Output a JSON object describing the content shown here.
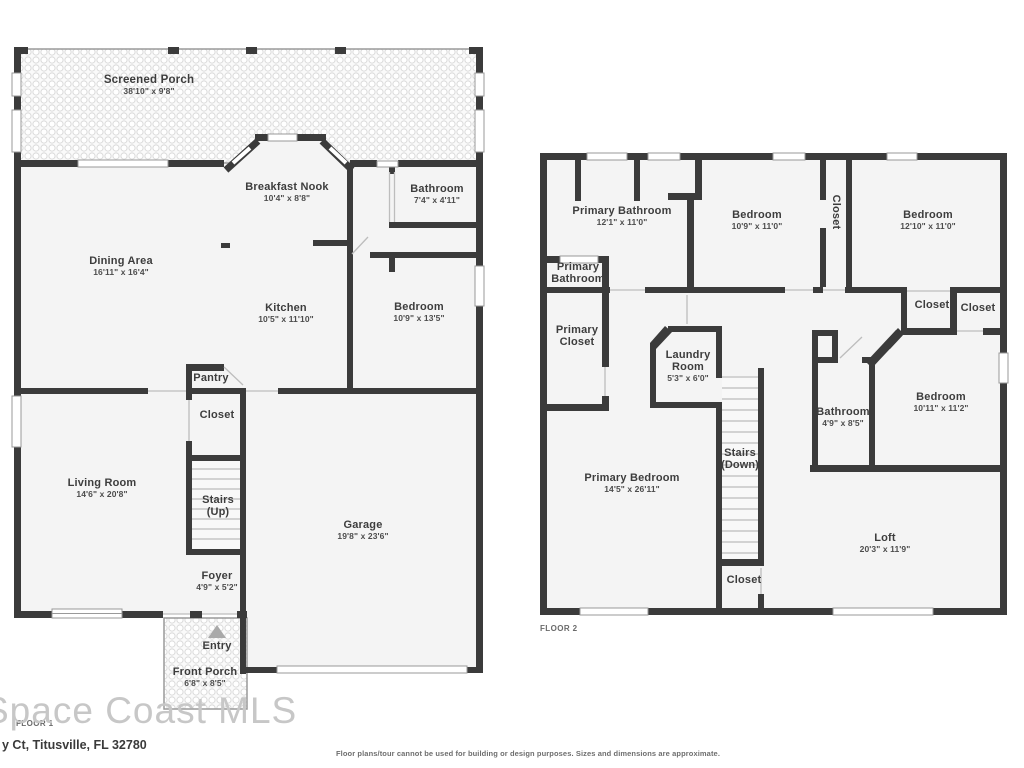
{
  "watermark": "Space Coast MLS",
  "address": "y Ct, Titusville, FL 32780",
  "disclaimer": "Floor plans/tour cannot be used for building or design purposes. Sizes and dimensions are approximate.",
  "colors": {
    "wall": "#3b3b3b",
    "room_fill": "#f4f4f4",
    "text": "#3d3d3d",
    "watermark": "#c7c7c7"
  },
  "floor1": {
    "caption": "FLOOR 1",
    "rooms": {
      "screened_porch": {
        "name": "Screened Porch",
        "dims": "38'10\" x 9'8\""
      },
      "breakfast_nook": {
        "name": "Breakfast Nook",
        "dims": "10'4\" x 8'8\""
      },
      "bathroom": {
        "name": "Bathroom",
        "dims": "7'4\" x 4'11\""
      },
      "dining_area": {
        "name": "Dining Area",
        "dims": "16'11\" x 16'4\""
      },
      "kitchen": {
        "name": "Kitchen",
        "dims": "10'5\" x 11'10\""
      },
      "bedroom": {
        "name": "Bedroom",
        "dims": "10'9\" x 13'5\""
      },
      "pantry": {
        "name": "Pantry"
      },
      "closet": {
        "name": "Closet"
      },
      "living_room": {
        "name": "Living Room",
        "dims": "14'6\" x 20'8\""
      },
      "stairs": {
        "name": "Stairs",
        "dims": "(Up)"
      },
      "garage": {
        "name": "Garage",
        "dims": "19'8\" x 23'6\""
      },
      "foyer": {
        "name": "Foyer",
        "dims": "4'9\" x 5'2\""
      },
      "entry": {
        "name": "Entry"
      },
      "front_porch": {
        "name": "Front Porch",
        "dims": "6'8\" x 8'5\""
      }
    }
  },
  "floor2": {
    "caption": "FLOOR 2",
    "rooms": {
      "primary_bathroom": {
        "name": "Primary Bathroom",
        "dims": "12'1\" x 11'0\""
      },
      "bedroom_a": {
        "name": "Bedroom",
        "dims": "10'9\" x 11'0\""
      },
      "hall_closet": {
        "name": "Closet"
      },
      "bedroom_b": {
        "name": "Bedroom",
        "dims": "12'10\" x 11'0\""
      },
      "primary_bathroom_small": {
        "name": "Primary Bathroom"
      },
      "primary_closet": {
        "name": "Primary Closet"
      },
      "laundry_room": {
        "name": "Laundry Room",
        "dims": "5'3\" x 6'0\""
      },
      "closet_a": {
        "name": "Closet"
      },
      "closet_b": {
        "name": "Closet"
      },
      "bathroom": {
        "name": "Bathroom",
        "dims": "4'9\" x 8'5\""
      },
      "bedroom_c": {
        "name": "Bedroom",
        "dims": "10'11\" x 11'2\""
      },
      "primary_bedroom": {
        "name": "Primary Bedroom",
        "dims": "14'5\" x 26'11\""
      },
      "stairs": {
        "name": "Stairs",
        "dims": "(Down)"
      },
      "closet_c": {
        "name": "Closet"
      },
      "loft": {
        "name": "Loft",
        "dims": "20'3\" x 11'9\""
      }
    }
  }
}
